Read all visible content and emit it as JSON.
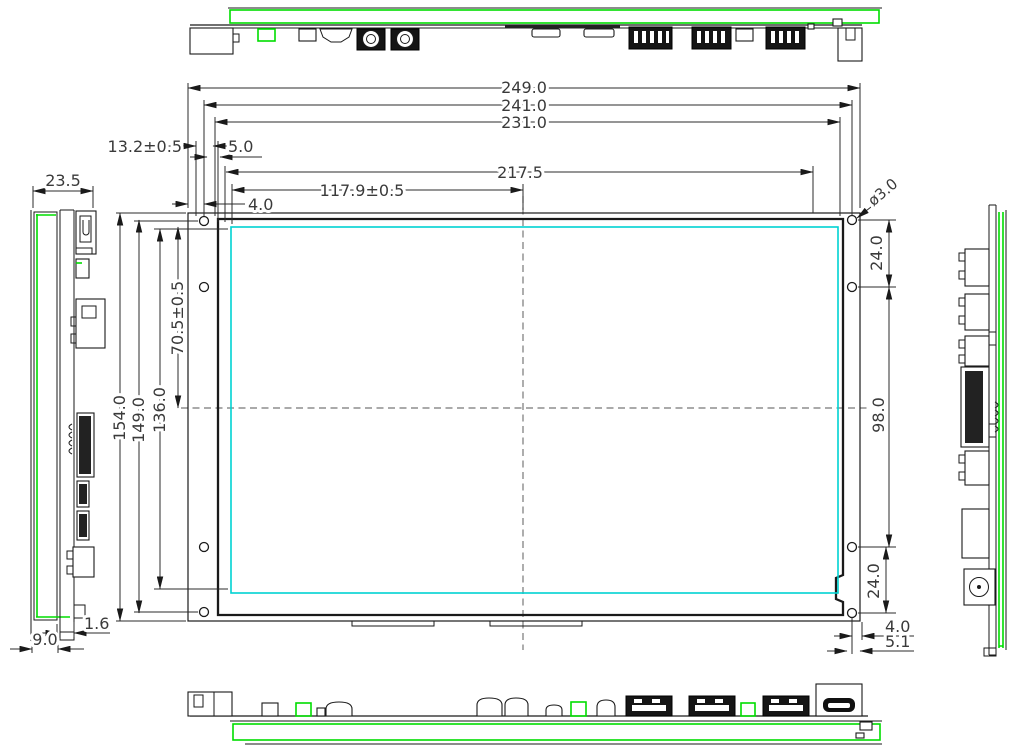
{
  "drawing": {
    "type": "mechanical-dimension-drawing",
    "subject": "LCD display module with mainboard shown in five orthographic views"
  },
  "dims": {
    "overall_width": "249.0",
    "mount_hole_span_width": "241.0",
    "frame_width": "231.0",
    "connector_offset": "13.2±0.5",
    "hole_to_frame": "5.0",
    "board_width": "217.5",
    "active_center_x": "117.9±0.5",
    "edge_to_hole": "4.0",
    "overall_height": "154.0",
    "mount_hole_span_height": "149.0",
    "frame_height": "136.0",
    "active_center_y": "70.5±0.5",
    "side_depth": "23.5",
    "panel_thickness": "1.6",
    "side_total_depth": "9.0",
    "hole_diameter": "ø3.0",
    "hole_pitch_top": "24.0",
    "hole_pitch_middle": "98.0",
    "hole_pitch_bottom": "24.0",
    "edge_to_hole_right": "4.0",
    "edge_to_notch": "5.1"
  },
  "colors": {
    "pcb_outline": "#00dd00",
    "active_area": "#00d2d2",
    "line": "#1a1a1a",
    "dim_text": "#3a3a3a",
    "centerline": "#777777"
  }
}
